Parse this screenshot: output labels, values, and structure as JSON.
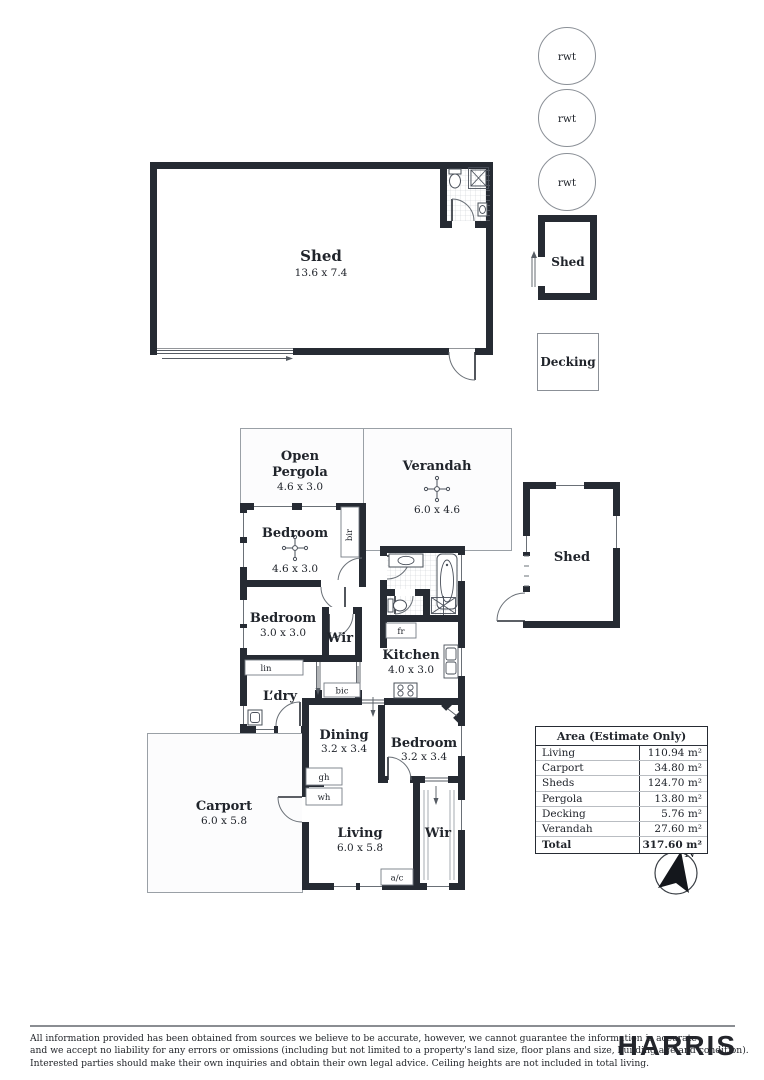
{
  "tanks": {
    "t1": "rwt",
    "t2": "rwt",
    "t3": "rwt"
  },
  "outbuildings": {
    "large_shed": {
      "name": "Shed",
      "dims": "13.6 x 7.4"
    },
    "side_shed": {
      "name": "Shed"
    },
    "decking": {
      "name": "Decking"
    },
    "rear_shed": {
      "name": "Shed"
    }
  },
  "rooms": {
    "open_pergola": {
      "line1": "Open",
      "line2": "Pergola",
      "dims": "4.6 x 3.0"
    },
    "verandah": {
      "name": "Verandah",
      "dims": "6.0 x 4.6"
    },
    "bedroom1": {
      "name": "Bedroom",
      "dims": "4.6 x 3.0"
    },
    "bedroom2": {
      "name": "Bedroom",
      "dims": "3.0 x 3.0"
    },
    "wir1": {
      "name": "Wir"
    },
    "kitchen": {
      "name": "Kitchen",
      "dims": "4.0 x 3.0"
    },
    "laundry": {
      "name": "L’dry"
    },
    "dining": {
      "name": "Dining",
      "dims": "3.2 x 3.4"
    },
    "bedroom3": {
      "name": "Bedroom",
      "dims": "3.2 x 3.4"
    },
    "carport": {
      "name": "Carport",
      "dims": "6.0 x 5.8"
    },
    "living": {
      "name": "Living",
      "dims": "6.0 x 5.8"
    },
    "wir2": {
      "name": "Wir"
    }
  },
  "fixtures": {
    "bir": "bir",
    "lin": "lin",
    "bic": "bic",
    "fr": "fr",
    "gh": "gh",
    "wh": "wh",
    "ac": "a/c"
  },
  "area_table": {
    "header": "Area (Estimate Only)",
    "rows": [
      {
        "label": "Living",
        "value": "110.94 m²"
      },
      {
        "label": "Carport",
        "value": "34.80 m²"
      },
      {
        "label": "Sheds",
        "value": "124.70 m²"
      },
      {
        "label": "Pergola",
        "value": "13.80 m²"
      },
      {
        "label": "Decking",
        "value": "5.76 m²"
      },
      {
        "label": "Verandah",
        "value": "27.60 m²"
      },
      {
        "label": "Total",
        "value": "317.60 m²"
      }
    ]
  },
  "compass": {
    "north_label": "N"
  },
  "footer": {
    "line1": "All information provided has been obtained from sources we believe to be accurate, however, we cannot guarantee the information is accurate",
    "line2": "and we accept no liability for any errors or omissions (including but not  limited to a property's land size, floor plans and size, building age and condition).",
    "line3": "Interested parties should make their own inquiries and obtain their own legal advice. Ceiling heights are not included in total living.",
    "logo": "HARRIS"
  },
  "colors": {
    "wall": "#262b33",
    "accent": "#8a8d92"
  }
}
